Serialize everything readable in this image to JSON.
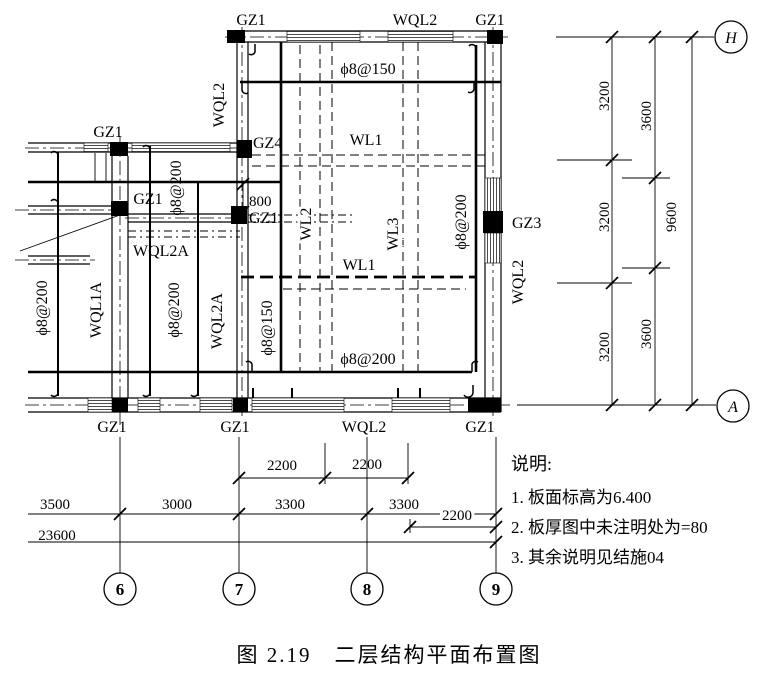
{
  "figure": {
    "caption": "图 2.19　二层结构平面布置图"
  },
  "notes": {
    "title": "说明:",
    "items": [
      "1. 板面标高为6.400",
      "2. 板厚图中未注明处为=80",
      "3. 其余说明见结施04"
    ]
  },
  "grid_axes": {
    "top": "H",
    "bottom": "A",
    "v6": "6",
    "v7": "7",
    "v8": "8",
    "v9": "9"
  },
  "labels": {
    "gz1_top_left": "GZ1",
    "wql2_top": "WQL2",
    "gz1_top_right": "GZ1",
    "gz1_wing_top": "GZ1",
    "gz4": "GZ4",
    "phi8_150_top": "ϕ8@150",
    "wl1_upper": "WL1",
    "gz1_wing_mid": "GZ1",
    "dim_800": "800",
    "gz1_axis7": "GZ1",
    "wql2a_h": "WQL2A",
    "wl1_lower": "WL1",
    "phi8_200_bottom": "ϕ8@200",
    "gz3": "GZ3",
    "wql2_left_v": "WQL2",
    "phi8_200_wing_v": "ϕ8@200",
    "phi8_200_a_v": "ϕ8@200",
    "wql1a_v": "WQL1A",
    "phi8_200_b_v": "ϕ8@200",
    "wql2a_v": "WQL2A",
    "phi8_150_v": "ϕ8@150",
    "wl2_v": "WL2",
    "wl3_v": "WL3",
    "phi8_200_room_v": "ϕ8@200",
    "wql2_right_v": "WQL2",
    "gz1_b6": "GZ1",
    "gz1_b7": "GZ1",
    "wql2_bottom": "WQL2",
    "gz1_b9": "GZ1"
  },
  "dimensions": {
    "right": {
      "d3200_1": "3200",
      "d3600_1": "3600",
      "d3200_2": "3200",
      "d9600": "9600",
      "d3200_3": "3200",
      "d3600_2": "3600"
    },
    "bottom": {
      "d2200_1": "2200",
      "d2200_2": "2200",
      "d3500": "3500",
      "d3000": "3000",
      "d3300_1": "3300",
      "d3300_2": "3300",
      "d2200_3": "2200",
      "d23600": "23600"
    }
  }
}
